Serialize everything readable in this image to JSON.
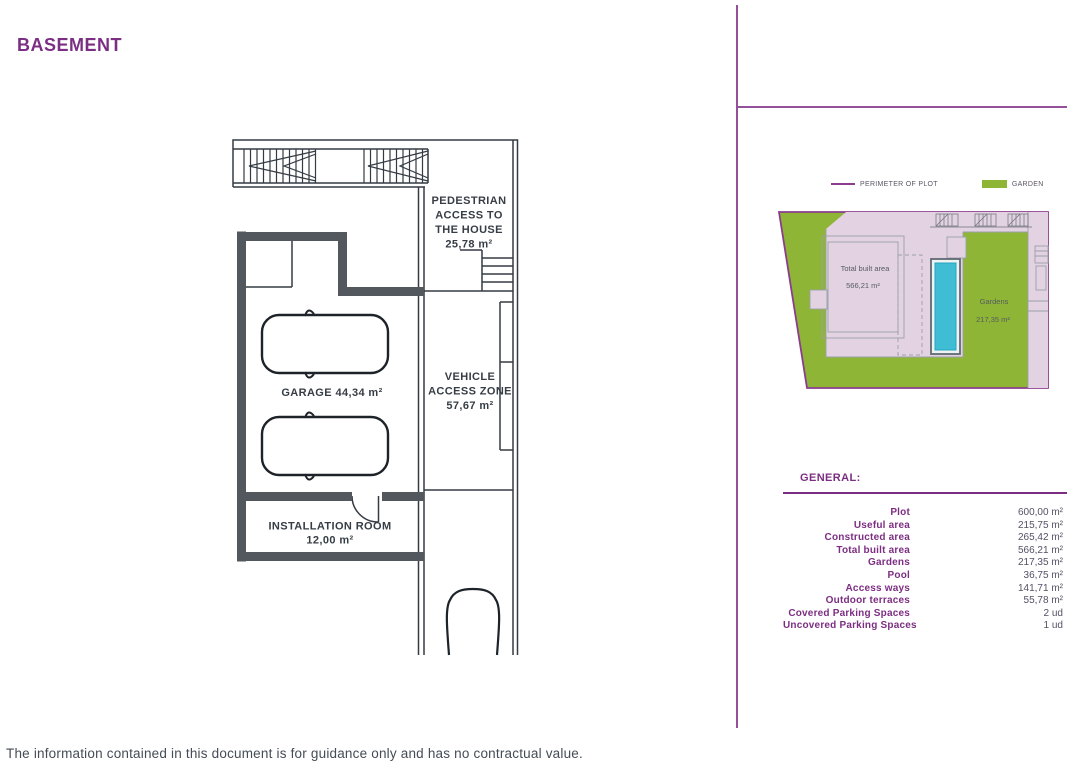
{
  "page": {
    "title": "BASEMENT",
    "disclaimer": "The information contained in this document is for guidance only and has no contractual value."
  },
  "floor_plan": {
    "pedestrian_access": {
      "line1": "PEDESTRIAN",
      "line2": "ACCESS TO",
      "line3": "THE HOUSE",
      "area": "25,78 m²"
    },
    "garage": {
      "label": "GARAGE 44,34 m²"
    },
    "vehicle_access": {
      "line1": "VEHICLE",
      "line2": "ACCESS ZONE",
      "area": "57,67 m²"
    },
    "installation_room": {
      "label": "INSTALLATION ROOM",
      "area": "12,00 m²"
    }
  },
  "site_plan": {
    "legend": [
      {
        "label": "PERIMETER OF PLOT",
        "color": "#8b3c8f"
      },
      {
        "label": "GARDEN",
        "color": "#8eb535"
      }
    ],
    "total_built_area": {
      "line1": "Total built area",
      "line2": "566,21 m²"
    },
    "gardens": {
      "line1": "Gardens",
      "line2": "217,35 m²"
    },
    "colors": {
      "garden": "#8eb535",
      "plot_fill": "#e2d2e2",
      "pool": "#3ebdd4",
      "perimeter": "#8b3c8f"
    }
  },
  "general": {
    "heading": "GENERAL:",
    "rows": [
      {
        "label": "Plot",
        "value": "600,00 m²"
      },
      {
        "label": "Useful area",
        "value": "215,75 m²"
      },
      {
        "label": "Constructed area",
        "value": "265,42 m²"
      },
      {
        "label": "Total built area",
        "value": "566,21 m²"
      },
      {
        "label": "Gardens",
        "value": "217,35 m²"
      },
      {
        "label": "Pool",
        "value": "36,75 m²"
      },
      {
        "label": "Access ways",
        "value": "141,71 m²"
      },
      {
        "label": "Outdoor terraces",
        "value": "55,78 m²"
      },
      {
        "label": "Covered Parking Spaces",
        "value": "2 ud"
      },
      {
        "label": "Uncovered Parking Spaces",
        "value": "1 ud"
      }
    ]
  }
}
